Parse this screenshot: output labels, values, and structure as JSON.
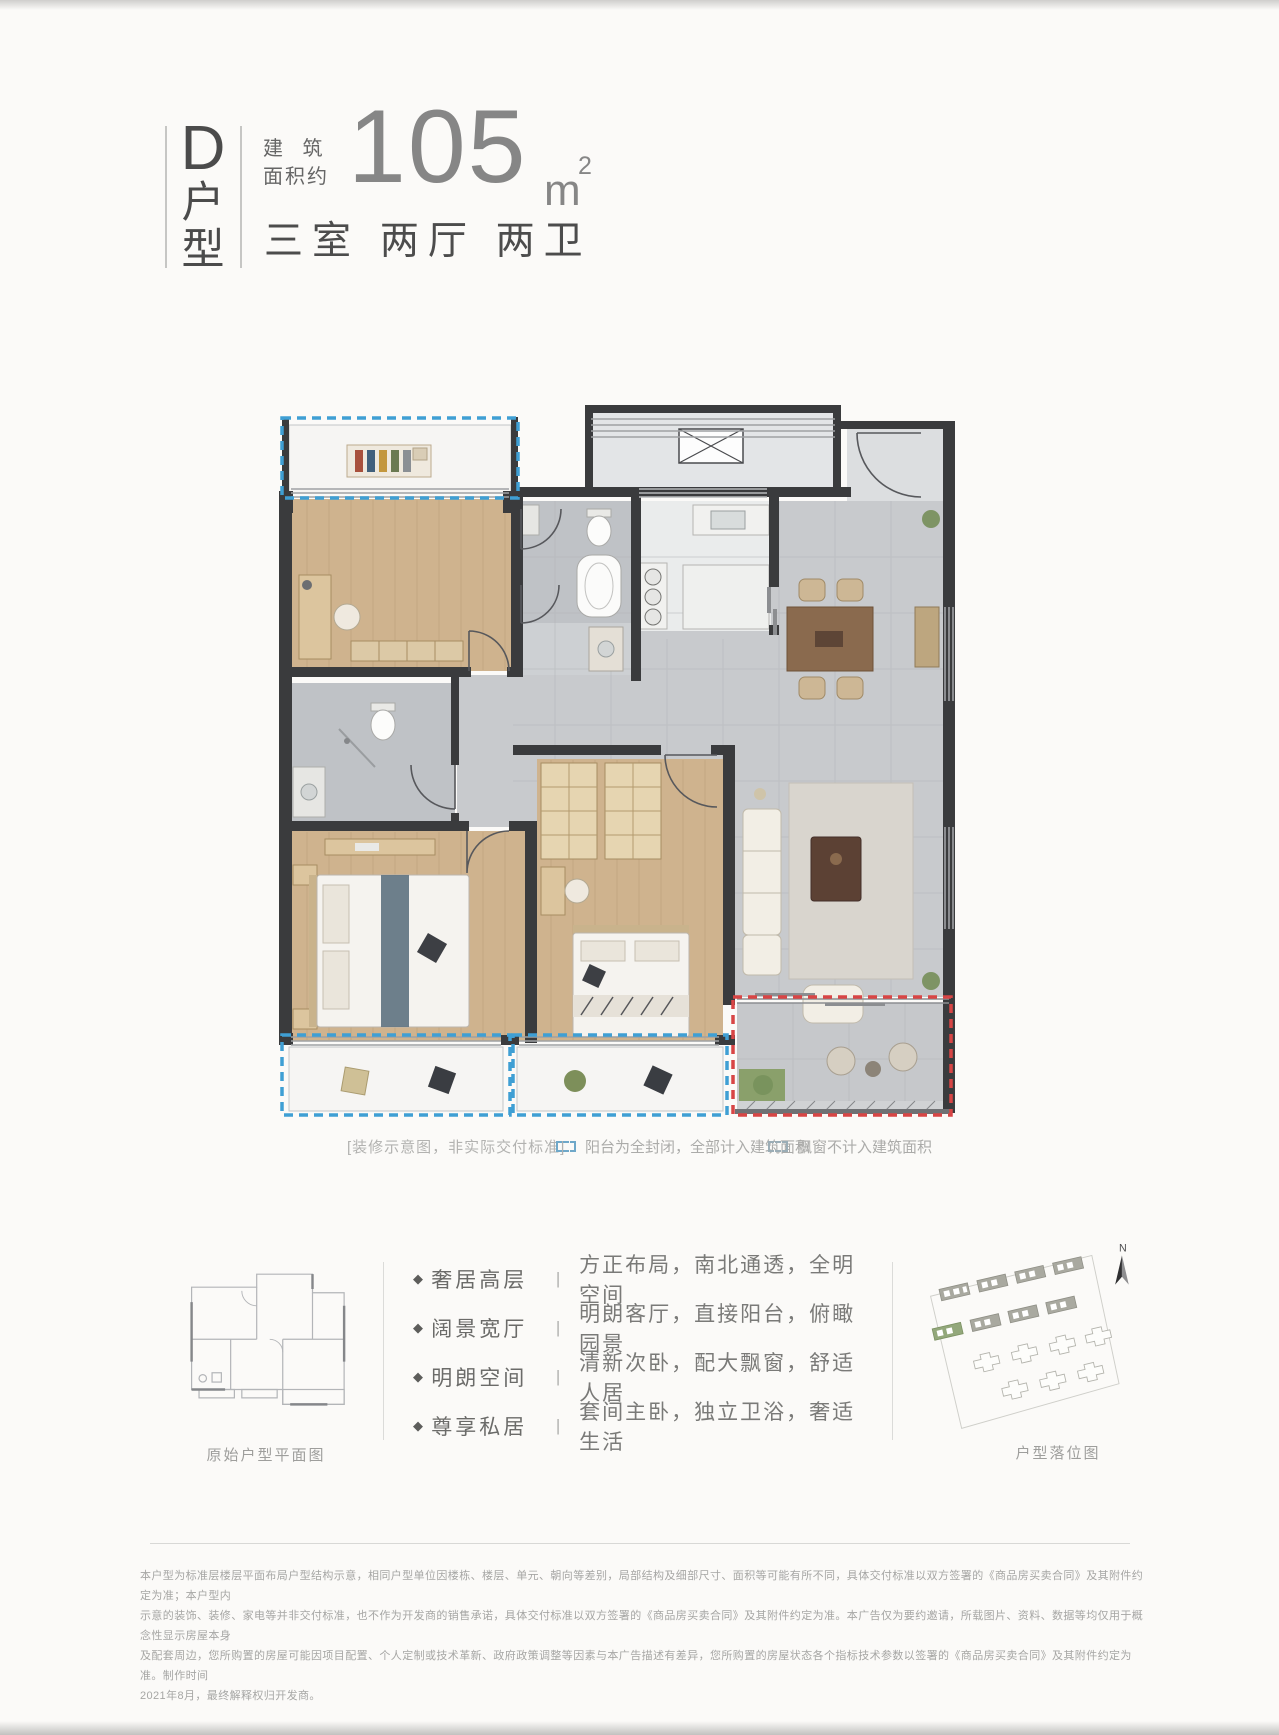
{
  "header": {
    "type_letter": "D",
    "type_char_1": "户",
    "type_char_2": "型",
    "area_label_line1": "建 筑",
    "area_label_line2": "面积约",
    "area_value": "105",
    "area_unit": "m",
    "area_superscript": "2",
    "rooms_summary": "三室 两厅 两卫"
  },
  "legend": {
    "note": "[装修示意图，非实际交付标准]",
    "items": [
      {
        "icon": "balcony-dash-icon",
        "color": "#6fa8c9",
        "label": "阳台为全封闭，全部计入建筑面积"
      },
      {
        "icon": "baywindow-dash-icon",
        "color": "#9badb6",
        "label": "飘窗不计入建筑面积"
      }
    ]
  },
  "bottom": {
    "original_plan_label": "原始户型平面图",
    "site_plan_label": "户型落位图",
    "north_label": "N",
    "bullet": "◆",
    "separator": "|",
    "features": [
      {
        "title": "奢居高层",
        "desc": "方正布局，南北通透，全明空间"
      },
      {
        "title": "阔景宽厅",
        "desc": "明朗客厅，直接阳台，俯瞰园景"
      },
      {
        "title": "明朗空间",
        "desc": "清新次卧，配大飘窗，舒适人居"
      },
      {
        "title": "尊享私居",
        "desc": "套间主卧，独立卫浴，奢适生活"
      }
    ]
  },
  "disclaimer": {
    "lines": [
      "本户型为标准层楼层平面布局户型结构示意，相同户型单位因楼栋、楼层、单元、朝向等差别，局部结构及细部尺寸、面积等可能有所不同，具体交付标准以双方签署的《商品房买卖合同》及其附件约定为准；本户型内",
      "示意的装饰、装修、家电等并非交付标准，也不作为开发商的销售承诺，具体交付标准以双方签署的《商品房买卖合同》及其附件约定为准。本广告仅为要约邀请，所载图片、资料、数据等均仅用于概念性显示房屋本身",
      "及配套周边，您所购置的房屋可能因项目配置、个人定制或技术革新、政府政策调整等因素与本广告描述有差异，您所购置的房屋状态各个指标技术参数以签署的《商品房买卖合同》及其附件约定为准。制作时间",
      "2021年8月，最终解释权归开发商。"
    ]
  },
  "floorplan_colors": {
    "wall": "#3a3b3d",
    "wood_floor": "#cfb38e",
    "tile_floor": "#c8cacd",
    "bay_window_dash": "#3f9fd4",
    "balcony_dash": "#d84545"
  }
}
